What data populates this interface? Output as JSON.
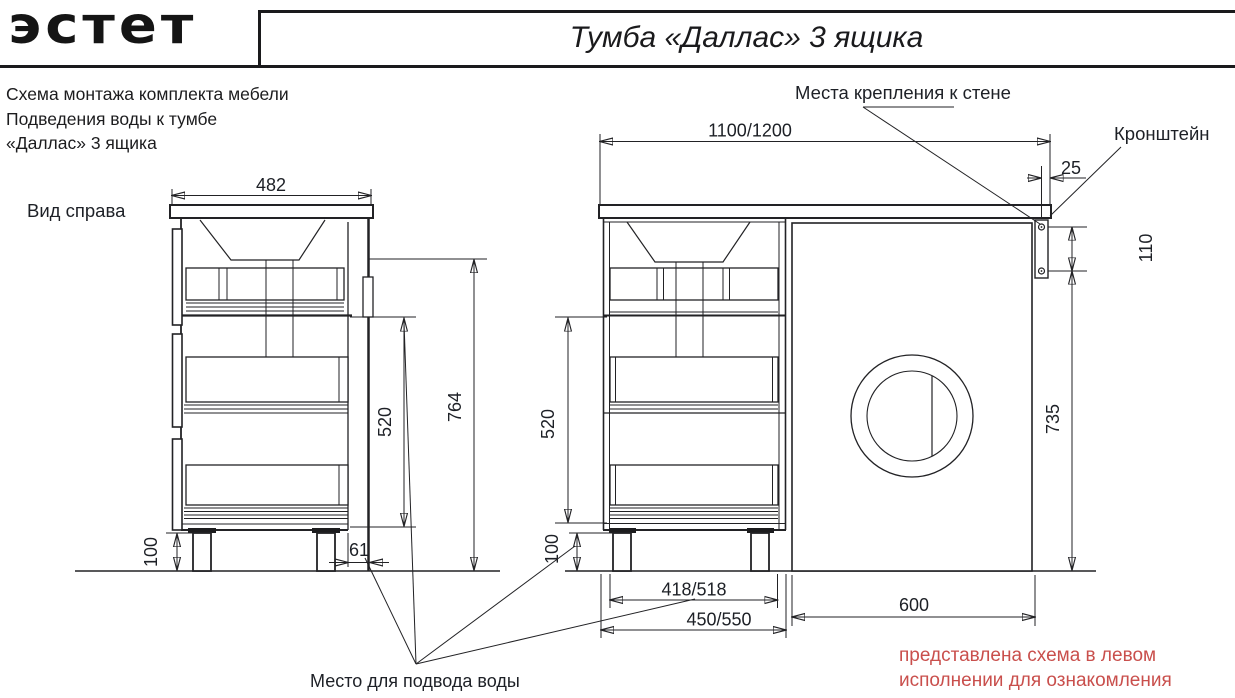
{
  "header": {
    "logo": "эстет",
    "title": "Тумба «Даллас» 3 ящика"
  },
  "intro": {
    "line1": "Схема монтажа комплекта мебели",
    "line2": "Подведения воды к тумбе",
    "line3": "«Даллас» 3 ящика"
  },
  "side_view": {
    "caption": "Вид справа",
    "dims": {
      "width": "482",
      "height": "764",
      "drawer_zone": "520",
      "legs": "100",
      "wall_gap": "61"
    }
  },
  "front_view": {
    "dims": {
      "width": "1100/1200",
      "overhang": "25",
      "bracket_holes": "110",
      "bracket_height": "735",
      "drawer_zone": "520",
      "legs": "100",
      "inner_width": "418/518",
      "cabinet_width": "450/550",
      "washer_niche": "600"
    }
  },
  "labels": {
    "wall_mount": "Места крепления к стене",
    "bracket": "Кронштейн",
    "water_supply": "Место для подвода воды"
  },
  "note": {
    "line1": "представлена схема в левом",
    "line2": "исполнении для ознакомления",
    "color": "#c94f4c"
  }
}
